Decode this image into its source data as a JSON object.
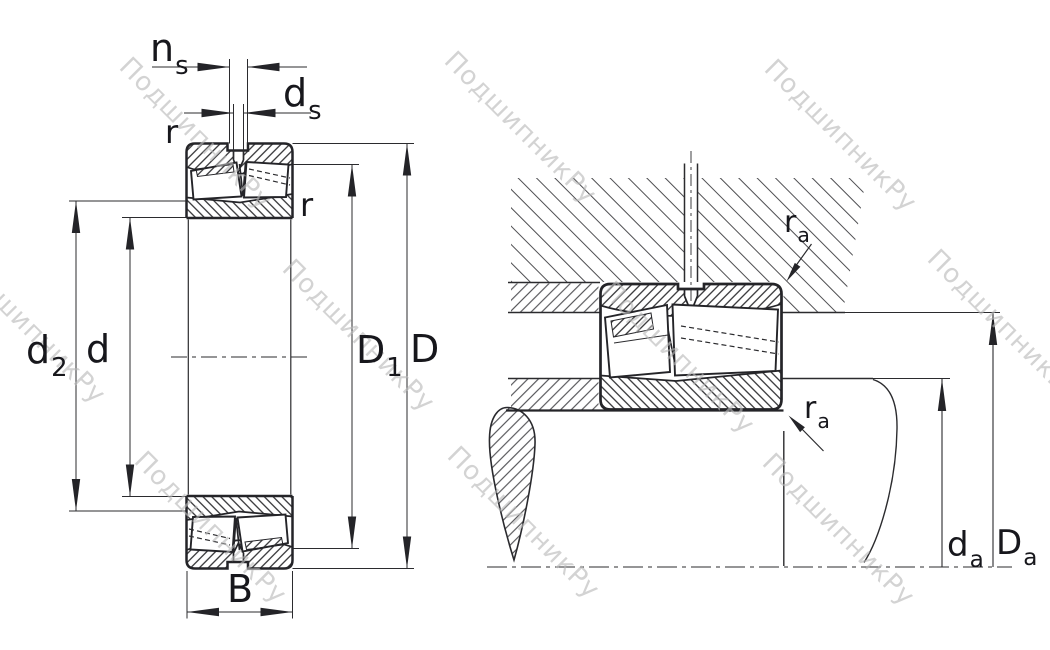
{
  "watermark": {
    "text": "ПодшипникРу"
  },
  "colors": {
    "line": "#2b2b2e",
    "label": "#17171c",
    "housing_hatch": "#4f4f52",
    "watermark": "#b9b9b9",
    "background": "#ffffff"
  },
  "labels": {
    "groove_width": {
      "base": "n",
      "sub": "s"
    },
    "hole_diameter": {
      "base": "d",
      "sub": "s"
    },
    "chamfer_top": "r",
    "chamfer_inner": "r",
    "recess_diameter": {
      "base": "d",
      "sub": "2"
    },
    "bore_diameter": "d",
    "groove_outer_diameter": {
      "base": "D",
      "sub": "1"
    },
    "outer_diameter": "D",
    "width": "B",
    "fillet_housing": {
      "base": "r",
      "sub": "a"
    },
    "fillet_shaft": {
      "base": "r",
      "sub": "a"
    },
    "shaft_abutment_diameter": {
      "base": "d",
      "sub": "a"
    },
    "housing_abutment_diameter": {
      "base": "D",
      "sub": "a"
    }
  }
}
